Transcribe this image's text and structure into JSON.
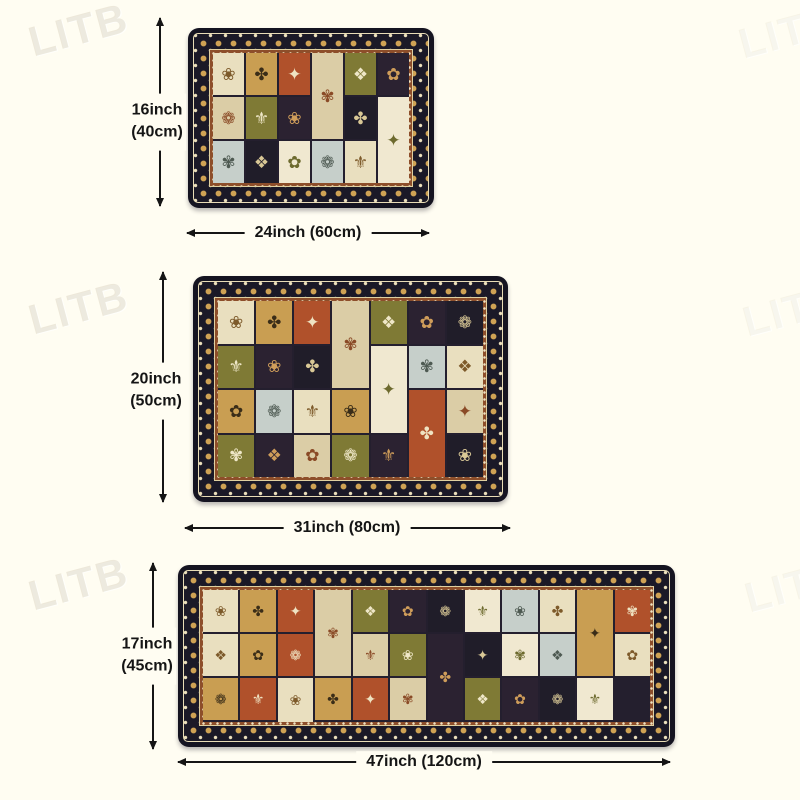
{
  "page": {
    "background": "#fffdf2",
    "arrow_color": "#151515",
    "label_color": "#151515"
  },
  "watermark": {
    "text": "LITB"
  },
  "rugs": [
    {
      "id": "small-mat",
      "height_label_line1": "16inch",
      "height_label_line2": "(40cm)",
      "width_label": "24inch (60cm)"
    },
    {
      "id": "medium-mat",
      "height_label_line1": "20inch",
      "height_label_line2": "(50cm)",
      "width_label": "31inch (80cm)"
    },
    {
      "id": "runner-mat",
      "height_label_line1": "17inch",
      "height_label_line2": "(45cm)",
      "width_label": "47inch (120cm)"
    }
  ],
  "rug_style": {
    "edge_color": "#151421",
    "border_band_color": "#1b1927",
    "guard_band_color": "#8d4e2a",
    "gold": "#cfa254",
    "cream": "#ece0bc",
    "tiles": [
      {
        "bg": "#e9dfbf",
        "fg": "#7d5a2a"
      },
      {
        "bg": "#b0512b",
        "fg": "#efe3c2"
      },
      {
        "bg": "#7f7a35",
        "fg": "#efe7c8"
      },
      {
        "bg": "#201d29",
        "fg": "#d9c896"
      },
      {
        "bg": "#c6cfca",
        "fg": "#4e5a52"
      },
      {
        "bg": "#c99e52",
        "fg": "#3a2d18"
      },
      {
        "bg": "#dbcda6",
        "fg": "#8a4a26"
      },
      {
        "bg": "#2b2231",
        "fg": "#cf9d5a"
      },
      {
        "bg": "#f0e8d0",
        "fg": "#6d6a2e"
      }
    ],
    "motifs": [
      "✿",
      "❀",
      "✾",
      "❁",
      "✤",
      "❖",
      "⚜",
      "✦"
    ]
  }
}
